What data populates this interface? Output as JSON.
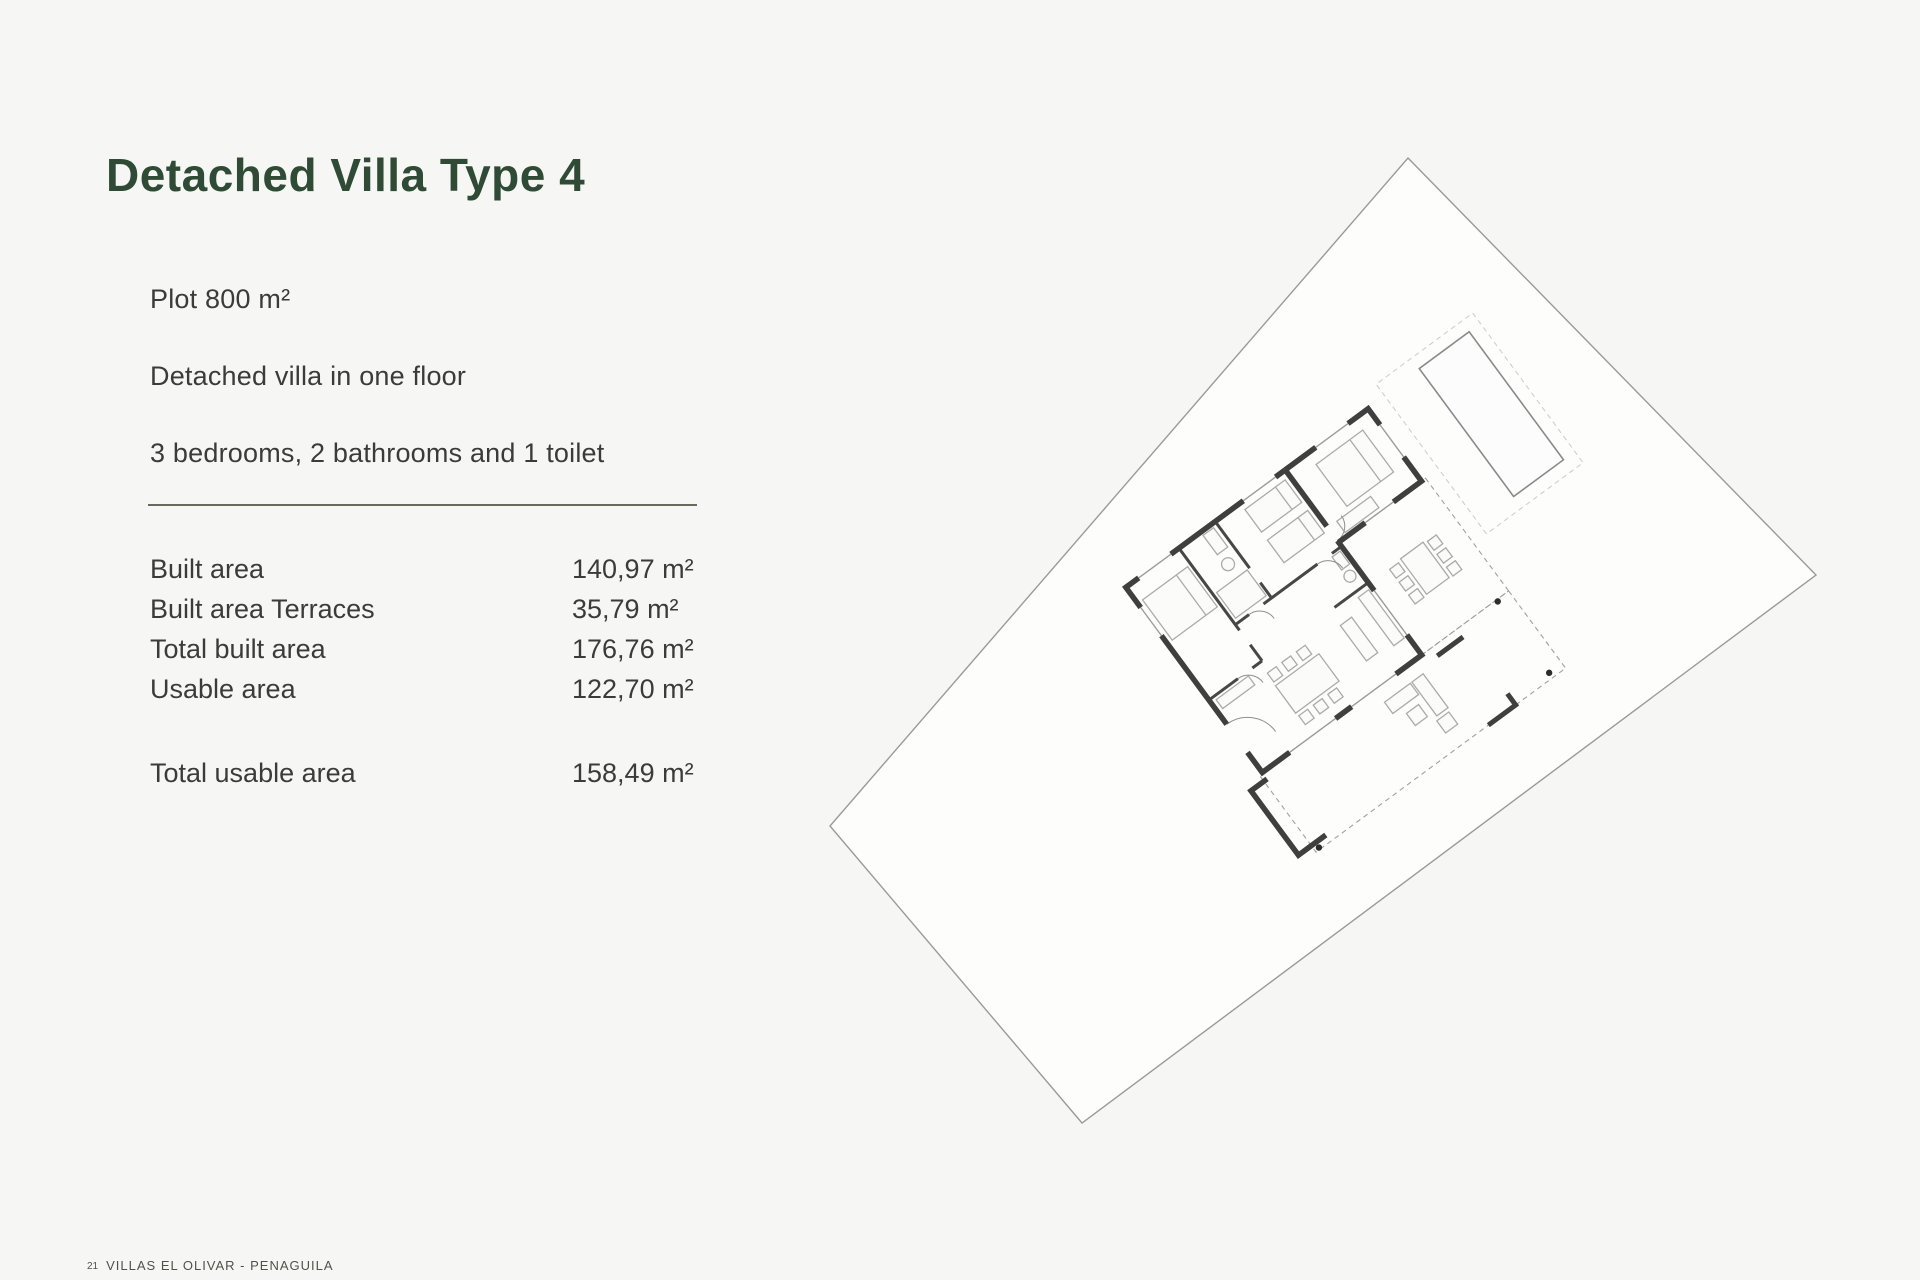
{
  "page": {
    "title": "Detached Villa Type 4",
    "title_color": "#2f4a35",
    "background_color": "#f6f6f5"
  },
  "details": {
    "plot": "Plot 800 m²",
    "floors": "Detached villa in one floor",
    "rooms": "3 bedrooms, 2 bathrooms and 1 toilet"
  },
  "areas": {
    "rows": [
      {
        "label": "Built area",
        "value": "140,97 m²"
      },
      {
        "label": "Built area Terraces",
        "value": "35,79 m²"
      },
      {
        "label": "Total built area",
        "value": "176,76 m²"
      },
      {
        "label": "Usable area",
        "value": "122,70 m²"
      }
    ],
    "total": {
      "label": "Total usable area",
      "value": "158,49 m²"
    }
  },
  "footer": {
    "page_number": "21",
    "text": "VILLAS EL OLIVAR - PENAGUILA"
  },
  "site_plan": {
    "description": "Rotated site plan: plot boundary, pool, detached one-floor villa floor plan with terraces",
    "divider_color": "#69695c",
    "wall_color": "#3f3f3f",
    "plot_stroke": "#9a9a9a",
    "furniture_color": "#ababab"
  }
}
